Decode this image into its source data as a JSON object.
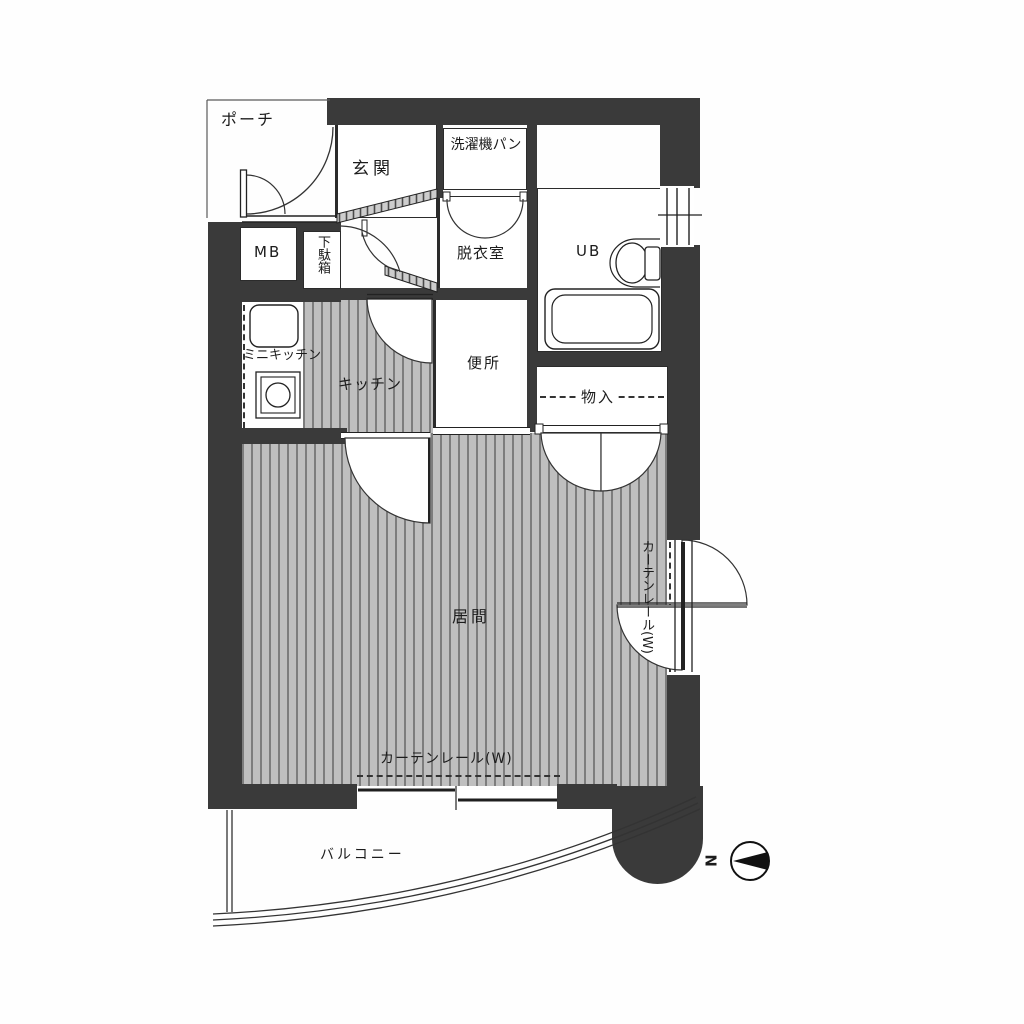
{
  "title": "apartment-floor-plan",
  "rooms": {
    "porch": "ポーチ",
    "entrance": "玄関",
    "washing_machine_pan": "洗濯機パン",
    "meter_box": "MB",
    "shoe_cabinet": "下駄箱",
    "dressing_room": "脱衣室",
    "unit_bath": "UB",
    "mini_kitchen": "ミニキッチン",
    "kitchen": "キッチン",
    "toilet": "便所",
    "storage": "物入",
    "living_room": "居間",
    "balcony": "バルコニー"
  },
  "annotations": {
    "curtain_rail_bottom": "カーテンレール(W)",
    "curtain_rail_right": "カーテンレール(W)",
    "compass_north": "N"
  },
  "colors": {
    "wall": "#3a3a3a",
    "floor_stripe_dark": "#7d7d7d",
    "floor_stripe_light": "#bfbfbf",
    "line": "#222222"
  }
}
